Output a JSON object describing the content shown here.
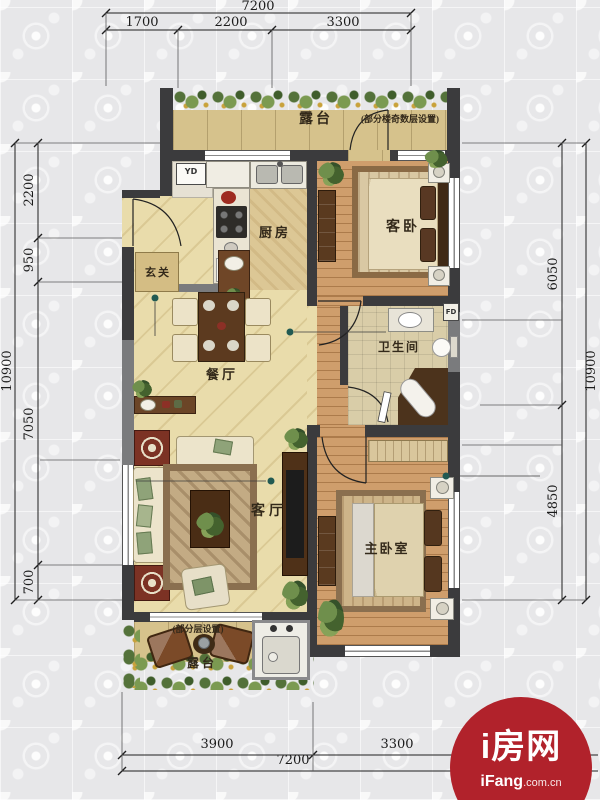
{
  "floor_plan": {
    "dimensions_mm": {
      "top": {
        "total": "7200",
        "segments": [
          "1700",
          "2200",
          "3300"
        ]
      },
      "bottom": {
        "total": "7200",
        "segments": [
          "3900",
          "3300"
        ]
      },
      "left": {
        "total": "10900",
        "segments": [
          "2200",
          "950",
          "7050",
          "700"
        ]
      },
      "right": {
        "total": "10900",
        "segments": [
          "6050",
          "4850"
        ]
      }
    },
    "rooms": {
      "terrace_top": {
        "name": "露台",
        "note": "(部分楼奇数层设置)"
      },
      "kitchen": {
        "name": "厨房"
      },
      "guest_bedroom": {
        "name": "客卧"
      },
      "entry": {
        "name": "玄关"
      },
      "dining_room": {
        "name": "餐厅"
      },
      "bathroom": {
        "name": "卫生间"
      },
      "living_room": {
        "name": "客厅"
      },
      "master_bedroom": {
        "name": "主卧室"
      },
      "terrace_bottom": {
        "name": "露台",
        "note": "(部分层设置)"
      }
    },
    "equipment_labels": {
      "yd": "YD",
      "fd": "FD"
    }
  },
  "watermark": {
    "brand": "i房网",
    "site_bold": "iFang",
    "site_suffix": ".com.cn",
    "color": "#b1222b"
  },
  "colors": {
    "wall": "#3b3b3d",
    "wall_light": "#7a7b7d",
    "floor_main": "#e9dcab",
    "floor_wood": "#cf9e6c",
    "floor_tile": "#d6c28c",
    "floor_bath": "#d9cda8",
    "background": "#e7e7e9",
    "dimension_text": "#1b1b1b",
    "watermark_red": "#b1222b"
  }
}
